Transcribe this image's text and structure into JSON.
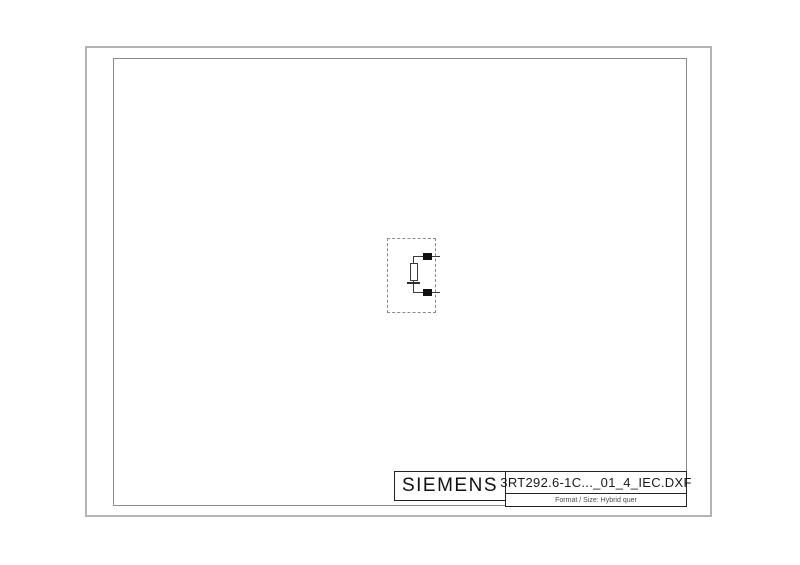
{
  "sheet": {
    "type": "dxf-schematic-sheet",
    "background": "#ffffff"
  },
  "title_block": {
    "brand": "SIEMENS",
    "filename": "3RT292.6-1C..._01_4_IEC.DXF",
    "format_label": "Format / Size: Hybrid quer"
  },
  "component": {
    "kind": "rc-surge-suppressor-symbol",
    "parts": [
      "dashed-outline",
      "resistor",
      "capacitor",
      "terminal-top",
      "terminal-bottom"
    ]
  },
  "colors": {
    "frame_outer": "#b3b3b3",
    "frame_inner": "#8c8c8c",
    "schematic_line": "#3a3a3a",
    "terminal_fill": "#101010",
    "title_block_line": "#222222"
  }
}
